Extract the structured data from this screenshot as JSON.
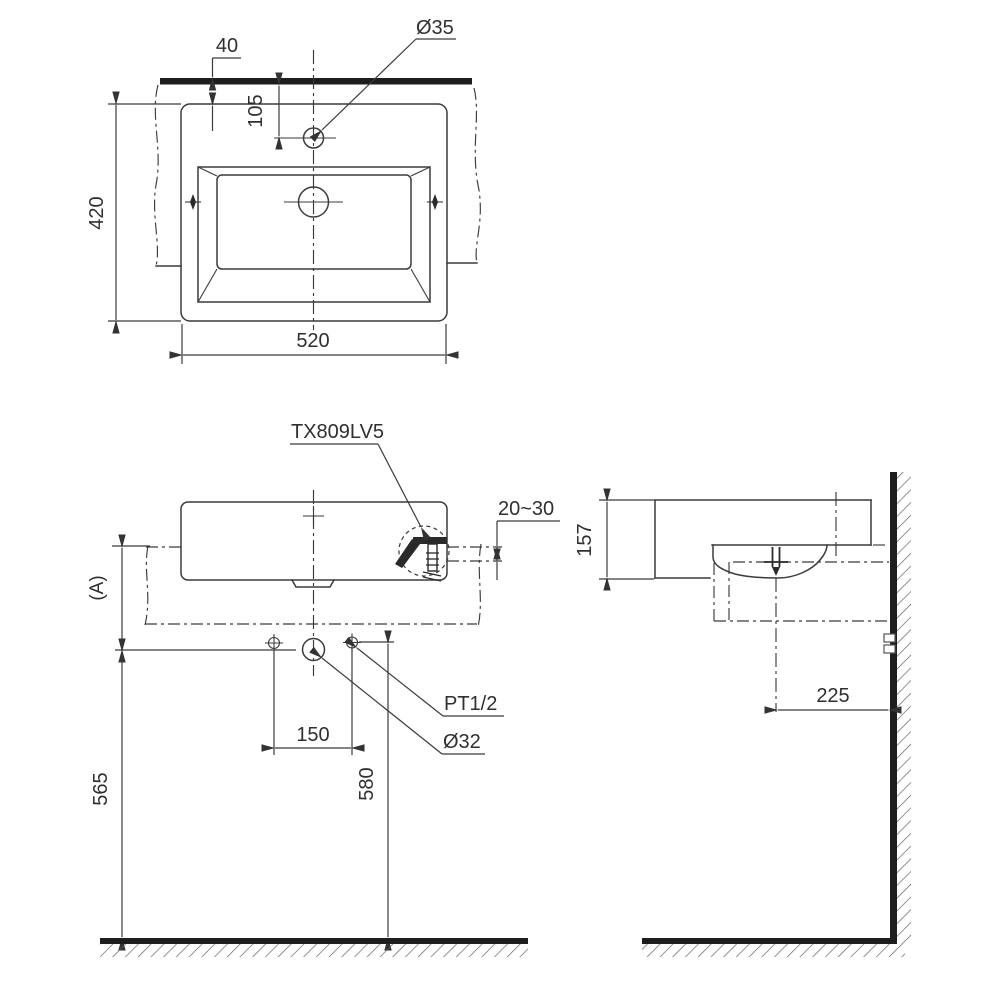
{
  "drawing": {
    "product_code": "TX809LV5",
    "views": {
      "plan": {
        "wall_to_rim": "40",
        "faucet_hole_diameter": "Ø35",
        "wall_to_faucet_center": "105",
        "basin_depth": "420",
        "basin_width": "520"
      },
      "front": {
        "counter_thickness": "20~30",
        "counter_height_ref": "(A)",
        "supply_hole_spacing": "150",
        "floor_to_drain_center": "565",
        "floor_to_supply_center": "580",
        "supply_thread": "PT1/2",
        "drain_hole_diameter": "Ø32"
      },
      "side": {
        "basin_height": "157",
        "drain_center_to_wall": "225"
      }
    }
  },
  "colors": {
    "line": "#3b3b3b",
    "heavy_line": "#1e1e1e",
    "text": "#2f2f2f",
    "hatch": "#5a5a5a",
    "background": "#ffffff"
  }
}
